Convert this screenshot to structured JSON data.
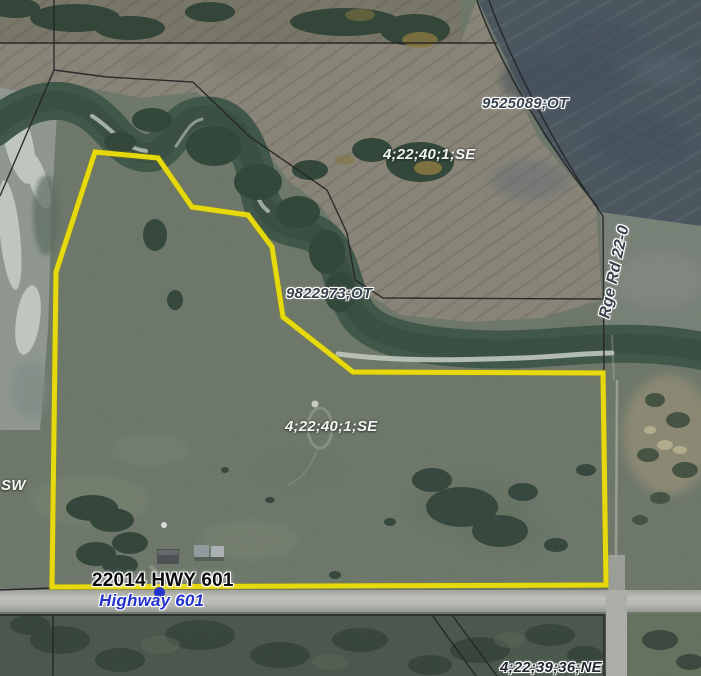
{
  "map": {
    "labels": {
      "parcel_top_right": "9525089;OT",
      "quarter_top": "4;22;40;1;SE",
      "parcel_creek": "9822973;OT",
      "road_right": "Rge Rd 22-0",
      "quarter_center": "4;22;40;1;SE",
      "quarter_west_partial": "SW",
      "address": "22014 HWY 601",
      "highway": "Highway 601",
      "quarter_bottom_right": "4;22;39;36;NE"
    },
    "colors": {
      "selection_outline": "#f8e900",
      "parcel_boundary": "#1c1c1c",
      "parcel_label": "#39434d",
      "quarter_label": "#f4f6f3",
      "address_label": "#0d0d0d",
      "road_label": "#2433cb",
      "address_marker": "#2433cb"
    }
  }
}
